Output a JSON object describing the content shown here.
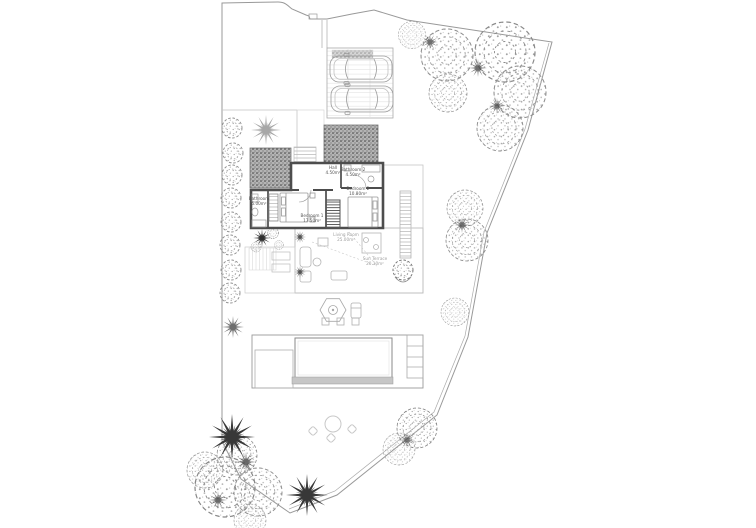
{
  "plan": {
    "type": "architectural-site-plan",
    "rooms": {
      "hall": {
        "name": "Hall",
        "area": "4.50m²"
      },
      "bathroom2": {
        "name": "Bathroom 2",
        "area": "4.50m²"
      },
      "bedroom2": {
        "name": "Bedroom 2",
        "area": "10.80m²"
      },
      "bedroom1": {
        "name": "Bedroom 1",
        "area": "17.50m²"
      },
      "bathroom1": {
        "name": "Bathroom",
        "area": "5.00m²"
      },
      "living": {
        "name": "Living Room",
        "area": "25.00m²"
      },
      "terrace": {
        "name": "Sun Terrace",
        "area": "20.10m²"
      }
    },
    "colors": {
      "paper": "#ffffff",
      "wall": "#4d4d4d",
      "boundary": "#999999",
      "light_line": "#bcbcbc",
      "gravel": "#b4b4b4",
      "foliage_dark": "#383838",
      "foliage_light": "#8c8c8c",
      "pool_band": "#c6c6c6"
    }
  }
}
